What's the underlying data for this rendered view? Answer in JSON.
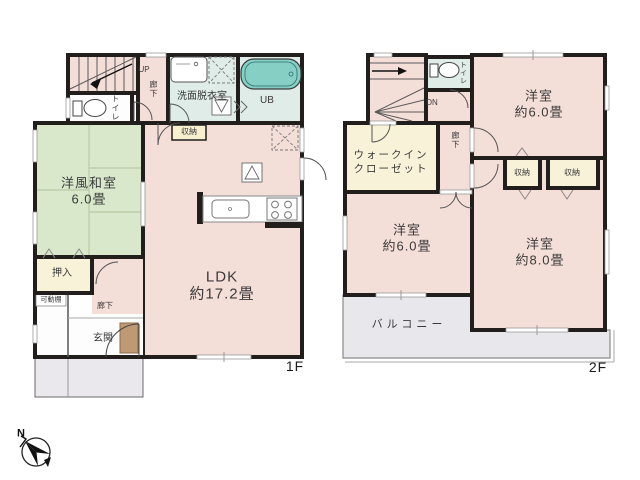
{
  "floor1": {
    "label": "1F",
    "stairs_direction": "UP",
    "rooms": {
      "washitsu_name": "洋風和室",
      "washitsu_size": "6.0畳",
      "ldk_name": "LDK",
      "ldk_size": "約17.2畳",
      "genkan": "玄関",
      "hall_lower": "廊下",
      "hall_upper": "廊下",
      "toilet": "トイレ",
      "washroom": "洗面脱衣室",
      "bath": "UB",
      "storage": "収納",
      "oshiire": "押入",
      "shelf": "可動棚"
    }
  },
  "floor2": {
    "label": "2F",
    "stairs_direction": "DN",
    "rooms": {
      "bedroom_ne_name": "洋室",
      "bedroom_ne_size": "約6.0畳",
      "bedroom_sw_name": "洋室",
      "bedroom_sw_size": "約6.0畳",
      "bedroom_se_name": "洋室",
      "bedroom_se_size": "約8.0畳",
      "wic_line1": "ウォークイン",
      "wic_line2": "クローゼット",
      "balcony": "バルコニー",
      "toilet": "トイレ",
      "hall": "廊下",
      "storage_a": "収納",
      "storage_b": "収納"
    }
  },
  "compass": {
    "north": "N"
  },
  "colors": {
    "wall": "#211e1c",
    "room_pink": "#f4ded8",
    "tatami_green": "#d9e8cb",
    "wet_mint": "#dfece7",
    "tub_teal": "#85cfc4",
    "closet_cream": "#f7f2d8",
    "balcony_gray": "#e8e8ec",
    "porch_gray": "#eae8ec",
    "cabinet_brown": "#bf9973",
    "text": "#3a3a3a"
  }
}
